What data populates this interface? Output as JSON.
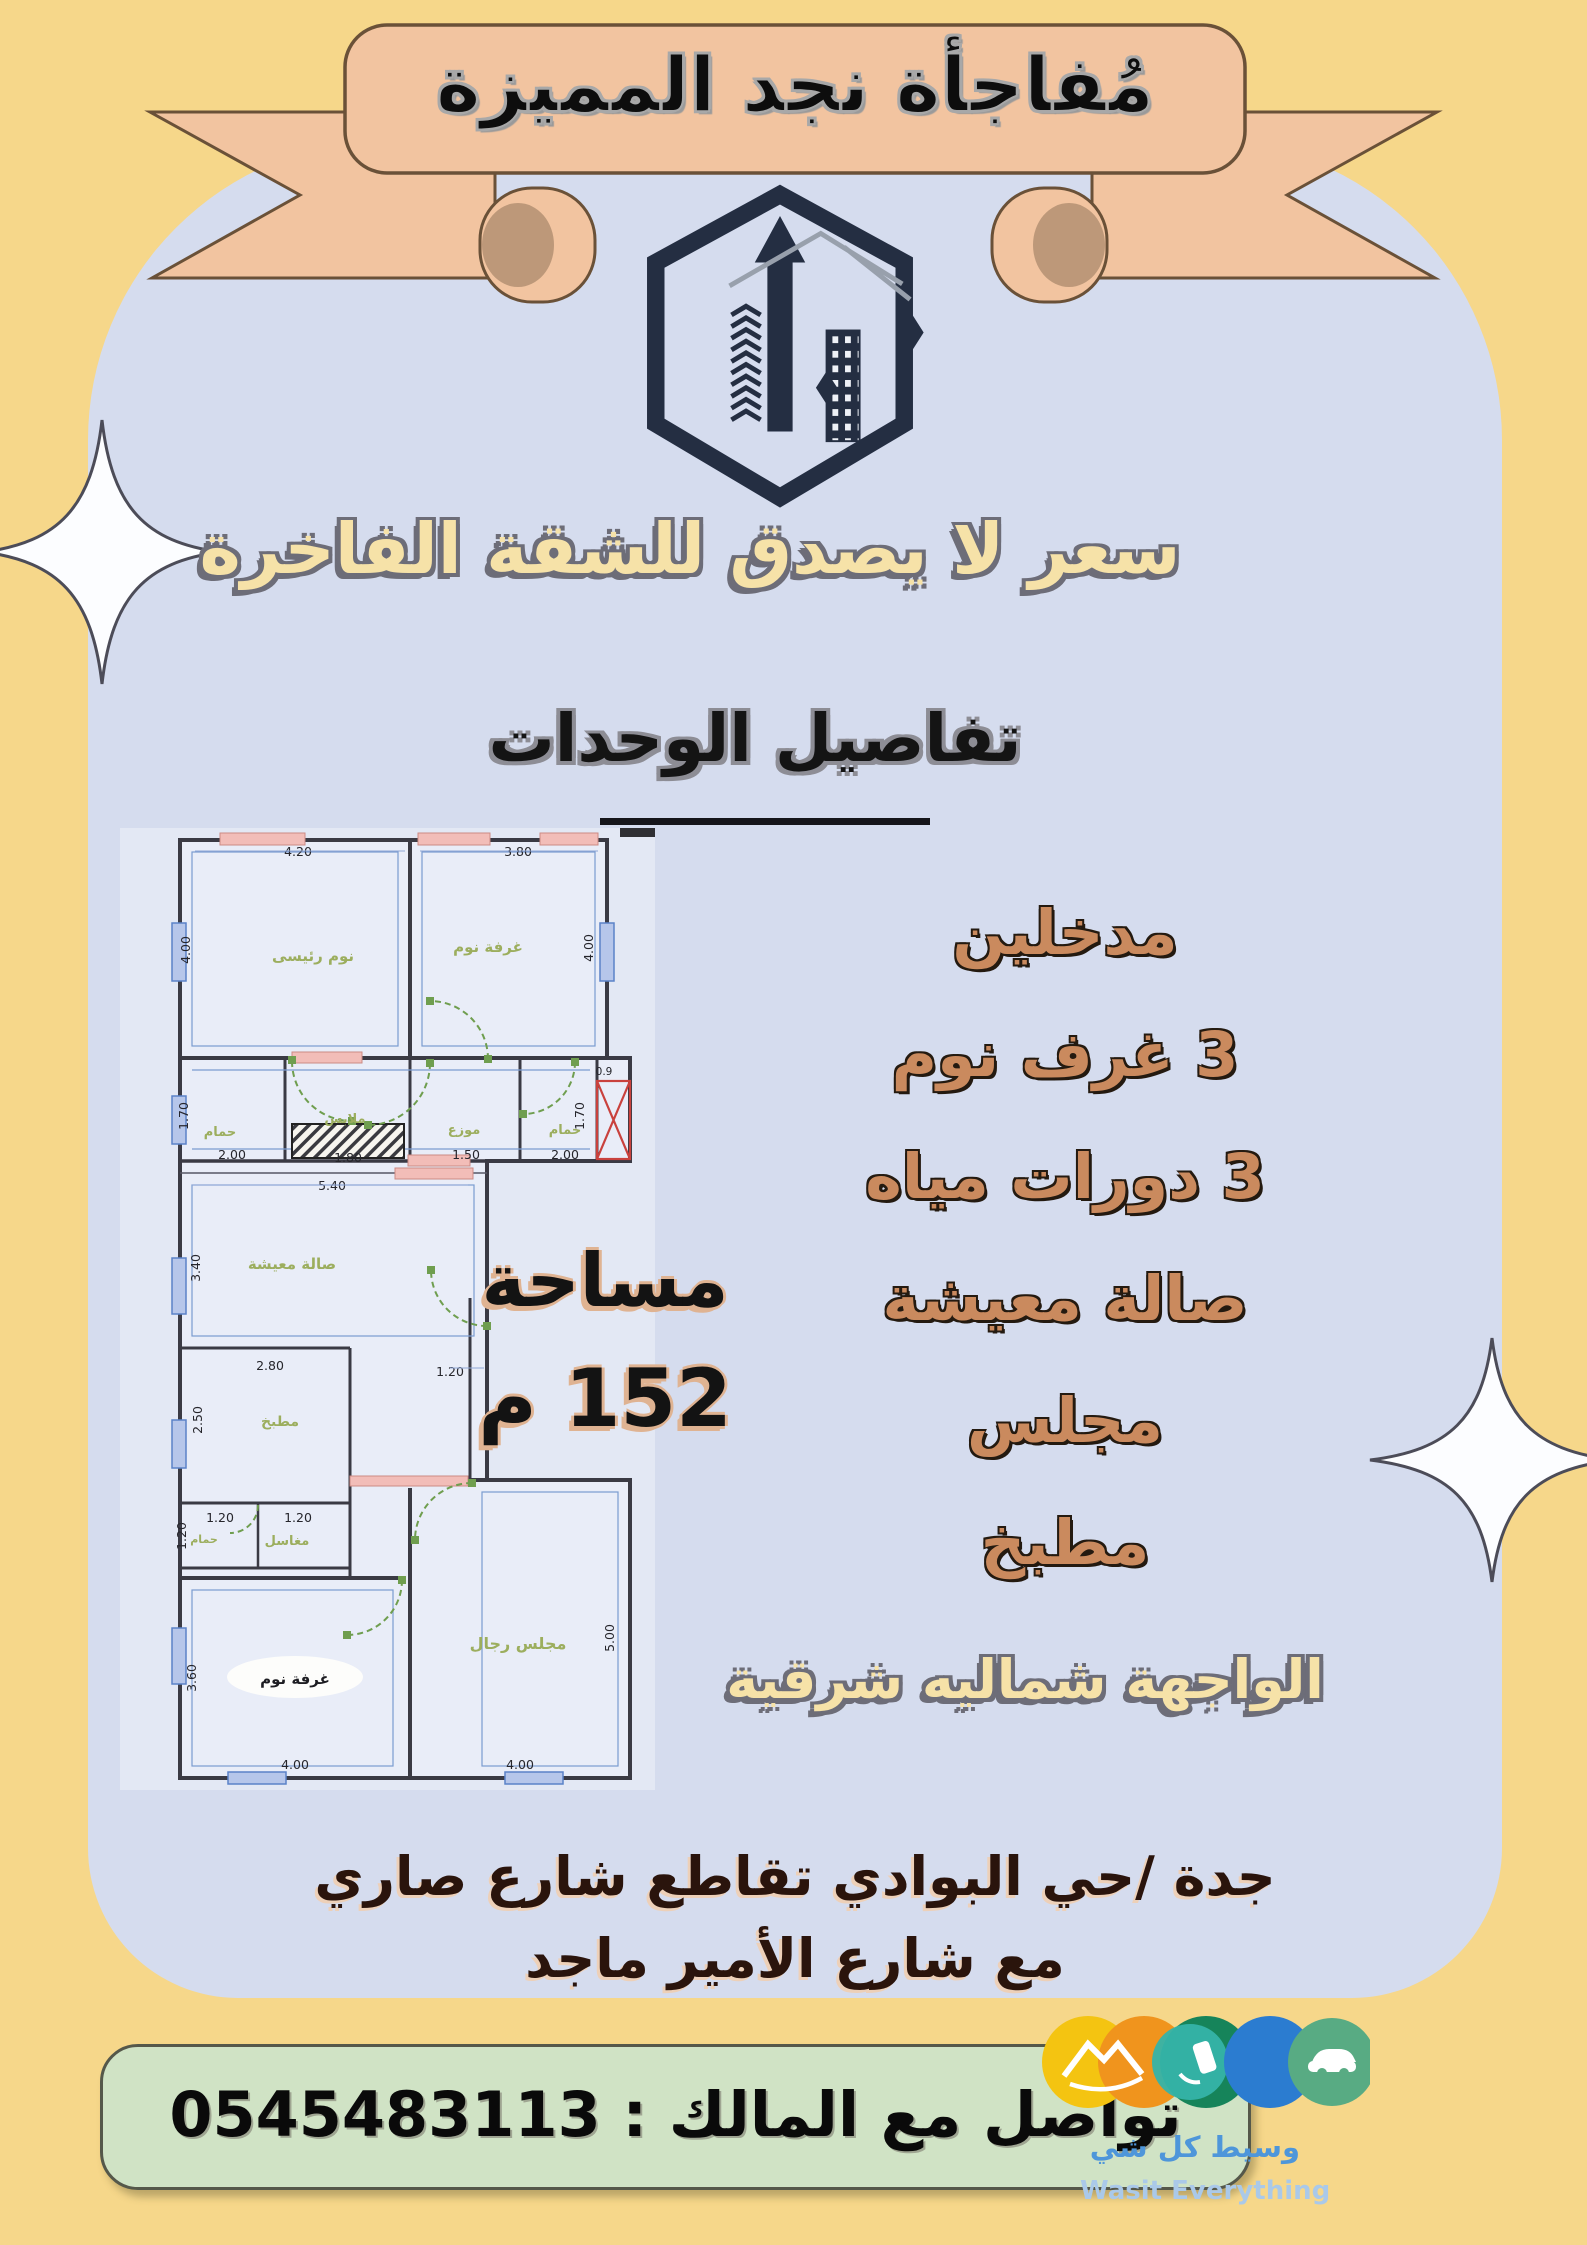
{
  "banner": {
    "title": "مُفاجأة نجد المميزة"
  },
  "headline": "سعر لا يصدق للشقة الفاخرة",
  "section": {
    "title": "تفاصيل الوحدات"
  },
  "features": [
    "مدخلين",
    "3 غرف نوم",
    "3 دورات مياه",
    "صالة معيشة",
    "مجلس",
    "مطبخ"
  ],
  "area": {
    "label": "مساحة",
    "value": "152 م"
  },
  "facade": "الواجهة شماليه شرقية",
  "address": {
    "line1": "جدة /حي البوادي تقاطع شارع صاري",
    "line2": "مع شارع الأمير ماجد"
  },
  "contact": {
    "label": "تواصل مع المالك :",
    "phone": "0545483113"
  },
  "brand": {
    "name_ar": "وسيط كل شي",
    "name_en": "Wasit Everything"
  },
  "colors": {
    "background": "#f6d78a",
    "card": "#d5dcee",
    "ribbon": "#f2c4a0",
    "headline_text": "#f6e2a8",
    "feature_text": "#ca8a5e",
    "bar": "#d0e3c5",
    "logo_navy": "#242e42"
  },
  "floorplan": {
    "labels": {
      "master": "نوم رئيسى",
      "bedroom2": "غرفة نوم",
      "bath_left": "حمام",
      "closet": "ملابس",
      "hall": "موزع",
      "bath_right": "حمام",
      "living": "صالة معيشة",
      "kitchen": "مطبخ",
      "sinks": "مغاسل",
      "bath_small": "حمام",
      "bedroom3": "غرفة نوم",
      "majlis": "مجلس رجال"
    },
    "dims": {
      "master_w": "4.20",
      "bed2_w": "3.80",
      "master_h": "4.00",
      "bed2_h": "4.00",
      "bath_row_h_l": "1.70",
      "bath_row_h_r": "1.70",
      "shaft": "0.9",
      "bath_l_w": "2.00",
      "closet_w": "1.80",
      "hall_w": "1.50",
      "bath_r_w": "2.00",
      "living_w": "5.40",
      "living_h": "3.40",
      "kitchen_w": "2.80",
      "kitchen_h": "2.50",
      "corridor_w": "1.20",
      "sink_w1": "1.20",
      "sink_w2": "1.20",
      "bath_s_h": "1.20",
      "bed3_h": "3.60",
      "majlis_h": "5.00",
      "bed3_w": "4.00",
      "majlis_w": "4.00"
    }
  }
}
